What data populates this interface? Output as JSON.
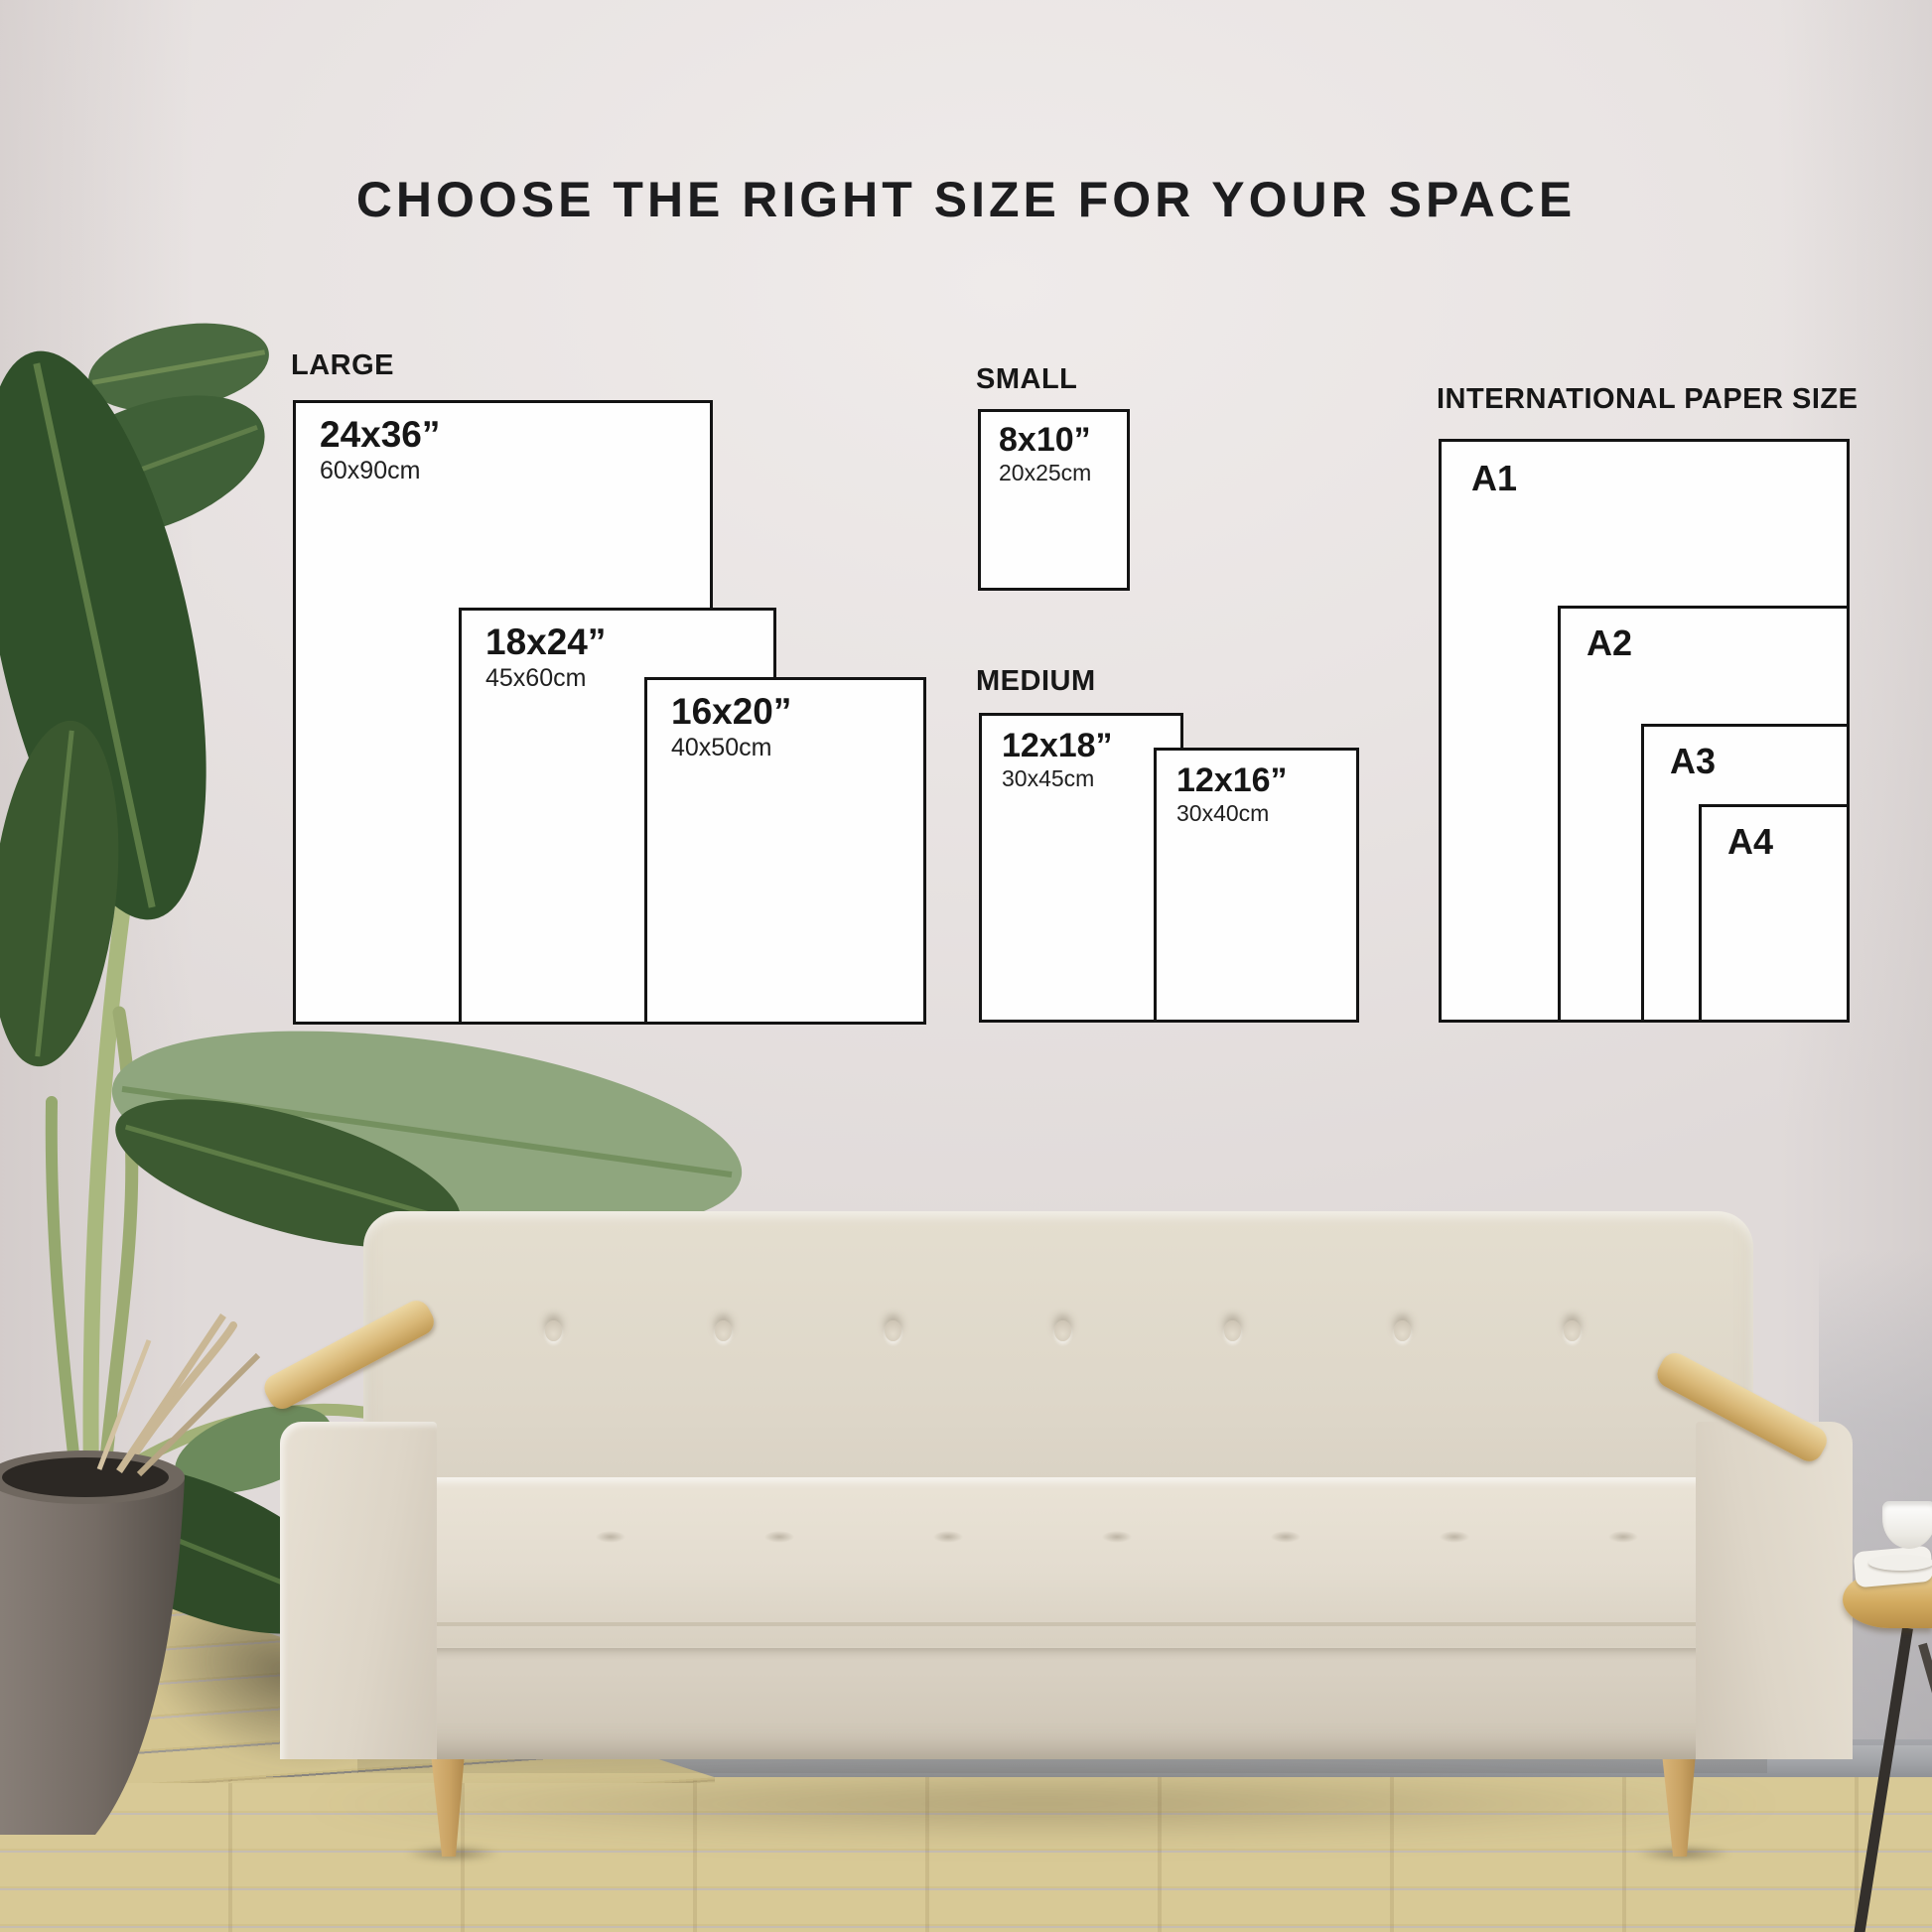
{
  "title": "CHOOSE THE RIGHT SIZE FOR YOUR SPACE",
  "groups": {
    "large": {
      "label": "LARGE",
      "sizes": [
        {
          "inches": "24x36”",
          "cm": "60x90cm"
        },
        {
          "inches": "18x24”",
          "cm": "45x60cm"
        },
        {
          "inches": "16x20”",
          "cm": "40x50cm"
        }
      ]
    },
    "small": {
      "label": "SMALL",
      "sizes": [
        {
          "inches": "8x10”",
          "cm": "20x25cm"
        }
      ]
    },
    "medium": {
      "label": "MEDIUM",
      "sizes": [
        {
          "inches": "12x18”",
          "cm": "30x45cm"
        },
        {
          "inches": "12x16”",
          "cm": "30x40cm"
        }
      ]
    },
    "international": {
      "label": "INTERNATIONAL PAPER SIZE",
      "sizes": [
        {
          "name": "A1"
        },
        {
          "name": "A2"
        },
        {
          "name": "A3"
        },
        {
          "name": "A4"
        }
      ]
    }
  },
  "colors": {
    "wall": "#e8e3e2",
    "text": "#1d1d1f",
    "box_border": "#131313",
    "box_fill": "#fefefe",
    "sofa_fabric": "#ded7c9",
    "armrest_wood": "#d9b878",
    "leg_wood": "#c9a263",
    "floor_wood": "#d5c593",
    "baseboard": "#a3a5a9",
    "plant_dark_green": "#30502a",
    "plant_sage_green": "#8fa67e",
    "pot_gray": "#7b726b",
    "table_wood": "#d3ab60"
  }
}
